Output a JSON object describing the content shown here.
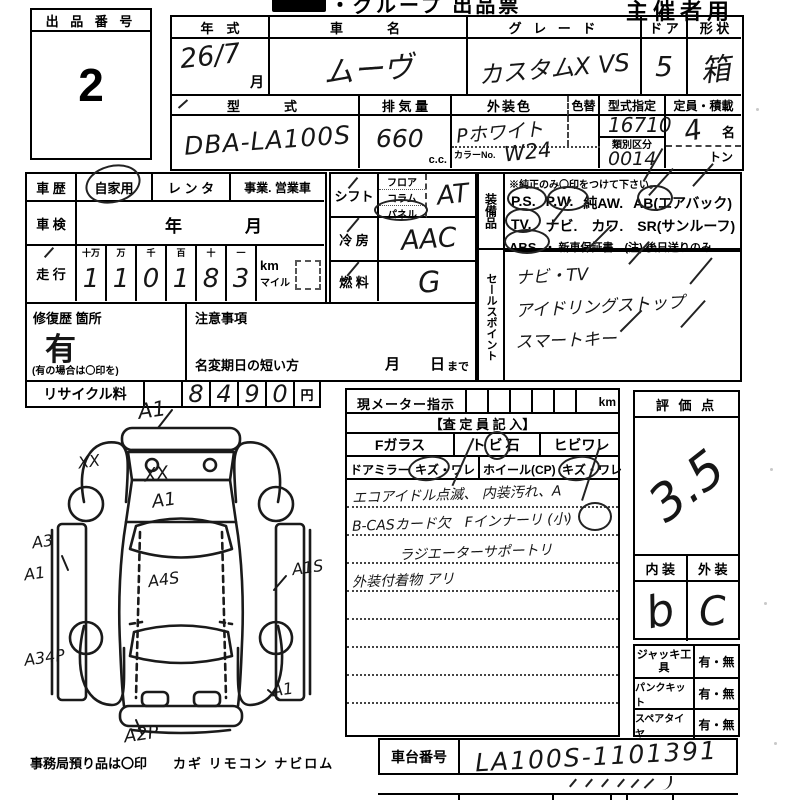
{
  "meta": {
    "title_suffix": "・グループ 出品票",
    "organizer": "主催者用"
  },
  "lot": {
    "label": "出 品 番 号",
    "number": "2"
  },
  "vehicle": {
    "year_label": "年　式",
    "year_value": "26/7",
    "month_label": "月",
    "name_label": "車　　名",
    "name_value": "ムーヴ",
    "grade_label": "グ レ ー ド",
    "grade_value": "カスタムX  VS",
    "door_label": "ド ア",
    "door_value": "5",
    "shape_label": "形 状",
    "shape_value": "箱",
    "model_label": "型　　式",
    "model_value": "DBA-LA100S",
    "disp_label": "排 気 量",
    "disp_value": "660",
    "disp_unit": "c.c.",
    "color_label": "外装色",
    "color_value": "Pホワイト",
    "colorno_label": "カラーNo.",
    "colorno_value": "W24",
    "color_change_label": "色替",
    "type_desig_label": "型式指定",
    "type_desig_value": "16710",
    "class_label": "類別区分",
    "class_value": "0014",
    "capacity_label": "定員・積載",
    "capacity_value": "4",
    "capacity_unit": "名",
    "ton_label": "トン"
  },
  "history": {
    "label": "車 歴",
    "private": "自家用",
    "rental": "レ ン タ",
    "business": "事業. 営業車",
    "inspection_label": "車 検",
    "inspection_year": "年",
    "inspection_month": "月",
    "mileage_label": "走 行",
    "digit_headers": [
      "十万",
      "万",
      "千",
      "百",
      "十",
      "一"
    ],
    "digits": [
      "1",
      "1",
      "0",
      "1",
      "8",
      "3"
    ],
    "unit_km": "km",
    "unit_mile": "マイル"
  },
  "repair": {
    "label": "修復歴 箇所",
    "value": "有",
    "note": "(有の場合は〇印を)"
  },
  "caution": {
    "label": "注意事項",
    "rename_label": "名変期日の短い方",
    "month": "月",
    "day": "日",
    "made": "まで"
  },
  "recycle": {
    "label": "リサイクル料",
    "digits": [
      "8",
      "4",
      "9",
      "0"
    ],
    "unit": "円"
  },
  "controls": {
    "shift_label": "シフト",
    "shift_floor": "フロア",
    "shift_column": "コラム",
    "shift_panel": "パネル",
    "shift_value": "AT",
    "ac_label": "冷 房",
    "ac_value": "AAC",
    "fuel_label": "燃 料",
    "fuel_value": "G"
  },
  "equipment": {
    "side_label": "装備品",
    "note": "※純正のみ〇印をつけて下さい。",
    "row1": [
      "P.S.",
      "P.W.",
      "純AW.",
      "AB(エアバック)"
    ],
    "row2": [
      "TV.",
      "ナビ.",
      "カワ.",
      "SR(サンルーフ)"
    ],
    "row3_abs": "ABS",
    "row3_rest": "・ 新車保証書←(注) 後日送りのみ"
  },
  "sales_points": {
    "side_label": "セールスポイント",
    "lines": [
      "ナビ・TV",
      "アイドリングストップ",
      "スマートキー"
    ]
  },
  "meter": {
    "label": "現メーター指示",
    "unit": "km",
    "assessor_header": "【査 定 員 記 入】",
    "fglass_label": "Fガラス",
    "fglass_opt1": "トビ石",
    "fglass_opt2": "ヒビワレ",
    "mirror_label": "ドアミラー",
    "mirror_opts": "キズ・ワレ",
    "wheel_label": "ホイール(CP)",
    "wheel_opts": "キズ・ワレ",
    "notes": [
      "エコアイドル点滅、 内装汚れ、A",
      "B-CASカード欠　Fインナーリ (小)",
      "ラジエーターサポートリ",
      "外装付着物 アリ"
    ]
  },
  "rating": {
    "label": "評 価 点",
    "score": "3.5",
    "interior_label": "内 装",
    "exterior_label": "外 装",
    "interior_value": "b",
    "exterior_value": "C"
  },
  "accessories": {
    "rows": [
      {
        "label": "ジャッキ工具",
        "value": "有・無"
      },
      {
        "label": "パンクキット",
        "value": "有・無"
      },
      {
        "label": "スペアタイヤ",
        "value": "有・無"
      }
    ]
  },
  "chassis": {
    "label": "車台番号",
    "value": "LA100S-1101391"
  },
  "office": {
    "note": "事務局預り品は〇印",
    "items": "カギ  リモコン  ナビロム"
  },
  "diagram": {
    "annotations": [
      "A1",
      "XX",
      "XX",
      "A1",
      "A3",
      "A1",
      "A1S",
      "A4S",
      "A34P",
      "A1",
      "A2P"
    ]
  }
}
